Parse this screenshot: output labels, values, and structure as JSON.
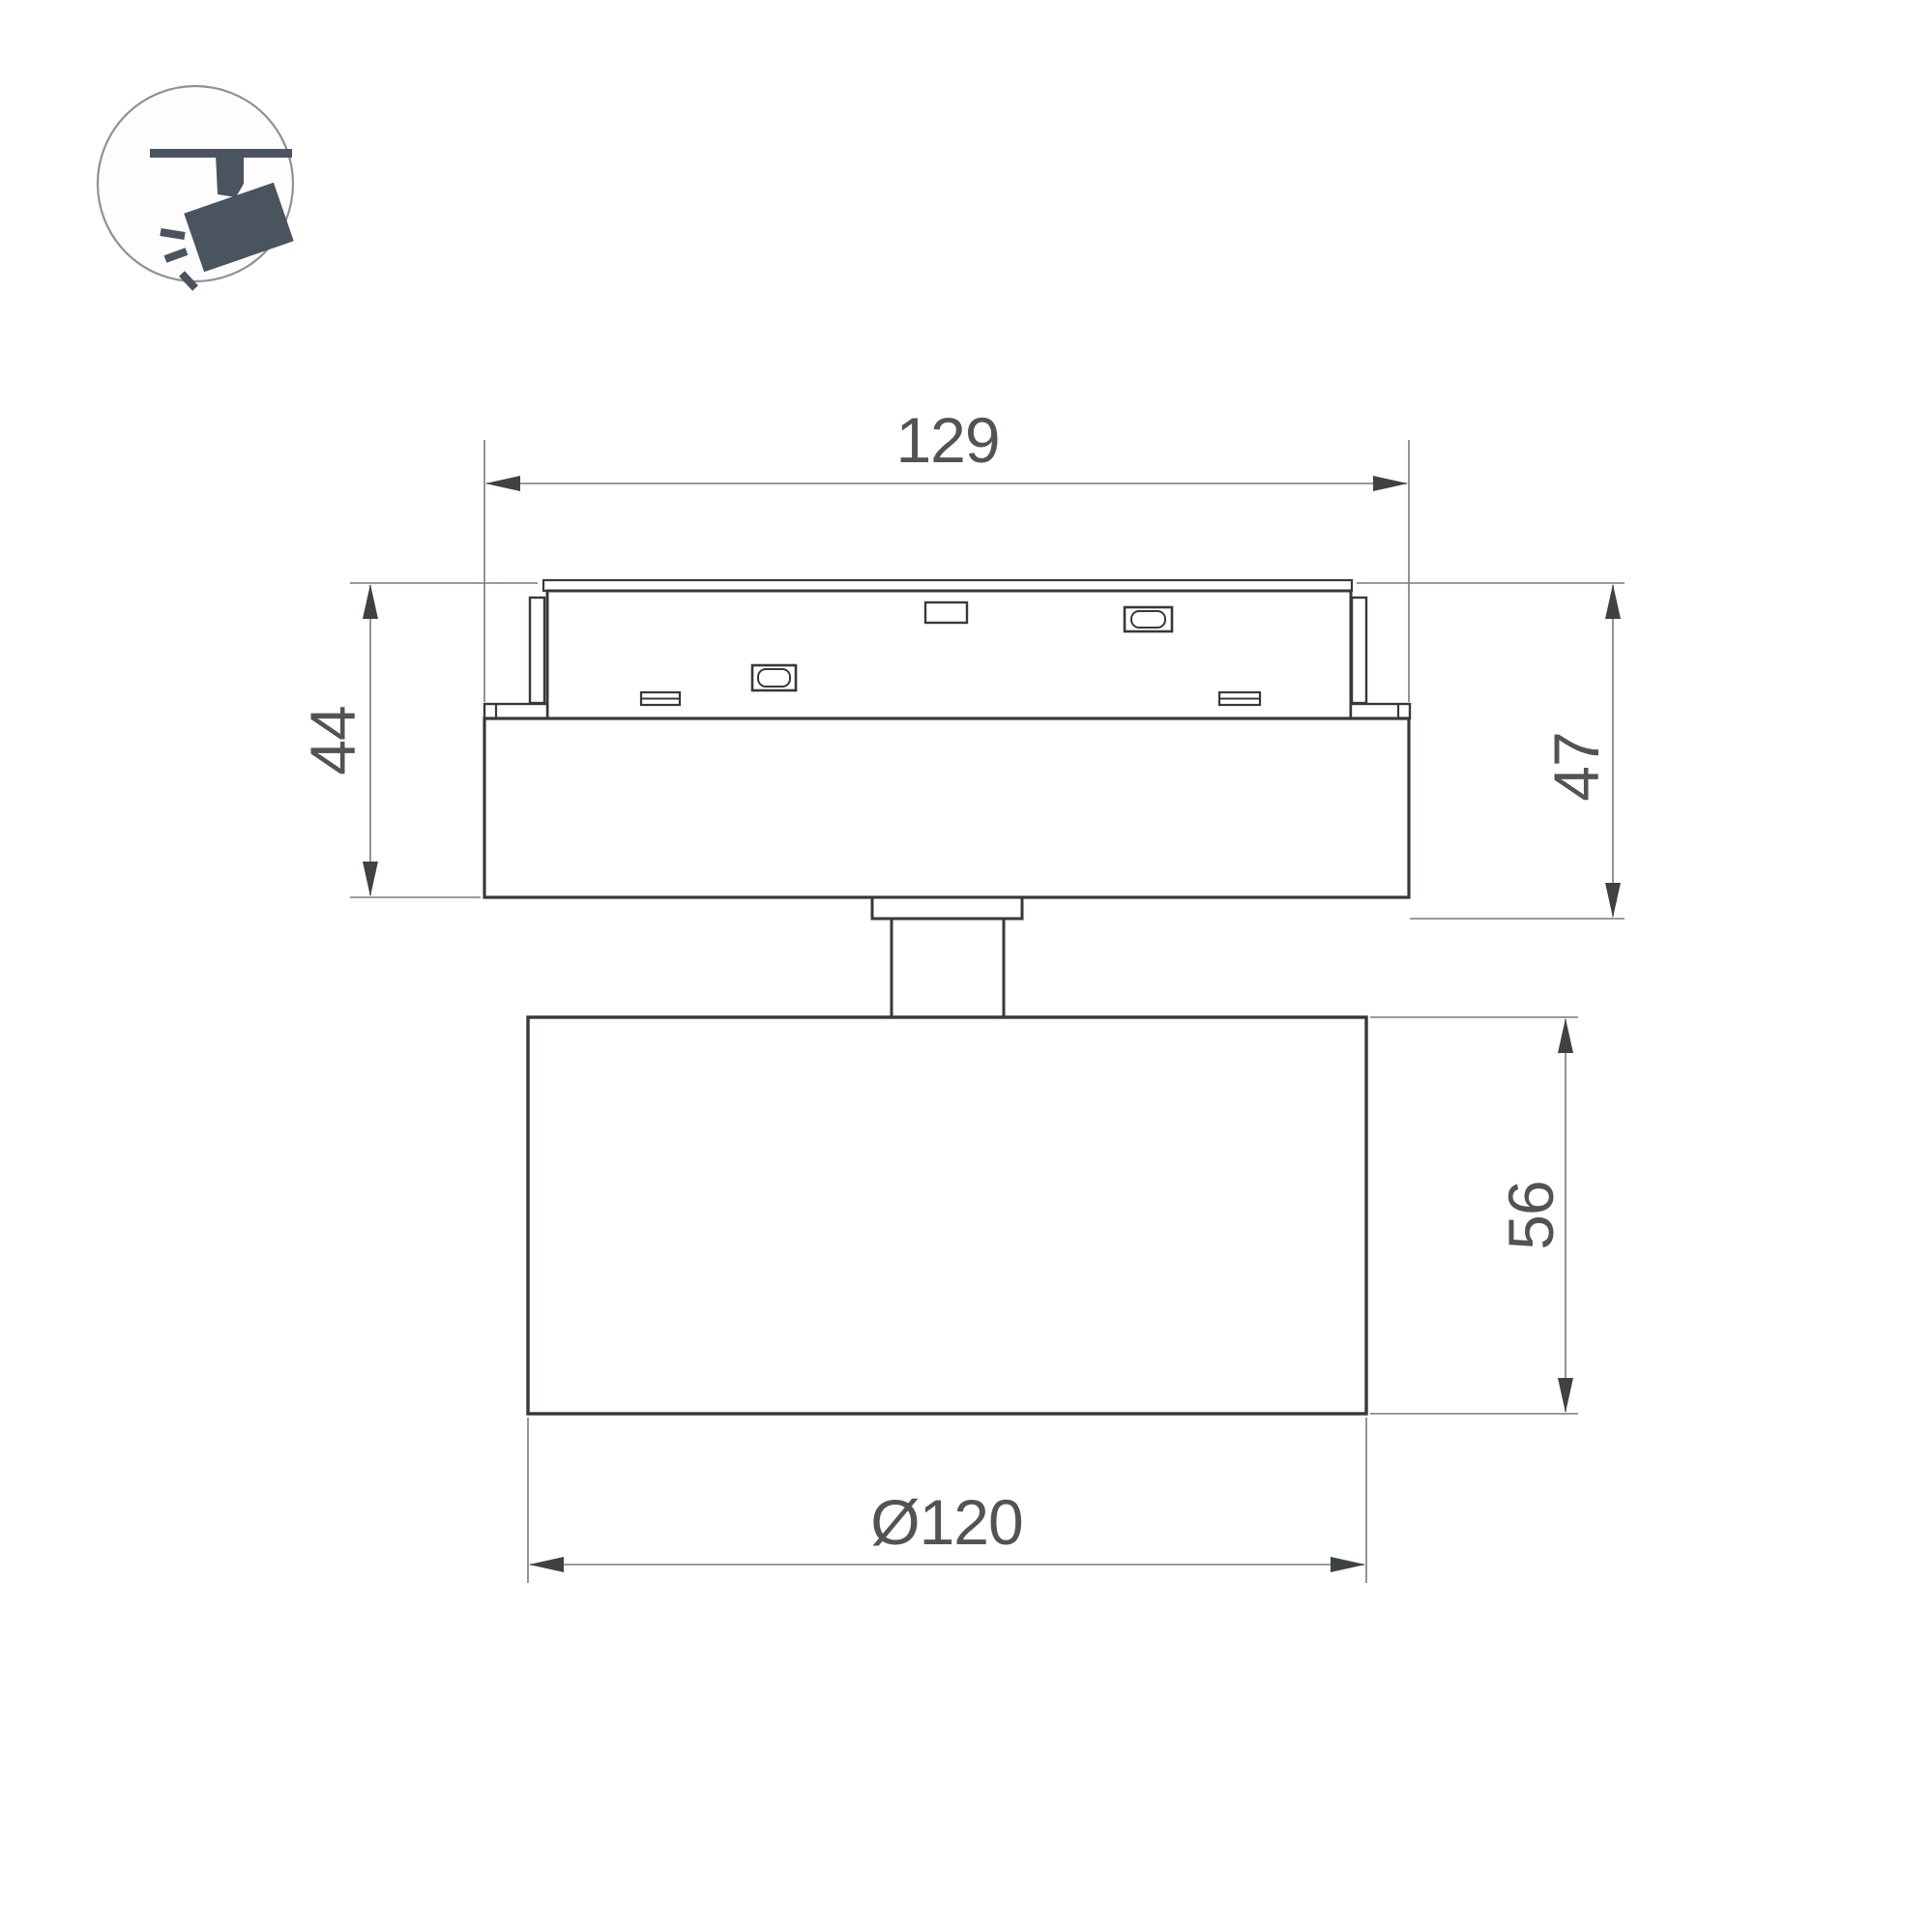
{
  "title": "track-spotlight-dimension-drawing",
  "colors": {
    "background": "#ffffff",
    "drawing_line": "#36393b",
    "dimension_line": "#77797c",
    "arrow": "#3e4245",
    "text": "#515356",
    "icon": "#4a545e",
    "icon_circle_stroke": "#8d9296"
  },
  "icon": {
    "name": "track-spotlight-icon"
  },
  "dimensions": {
    "adapter_width": {
      "label": "129"
    },
    "adapter_height": {
      "label": "44"
    },
    "overall_height": {
      "label": "47"
    },
    "head_height": {
      "label": "56"
    },
    "head_diameter": {
      "label": "Ø120"
    }
  }
}
